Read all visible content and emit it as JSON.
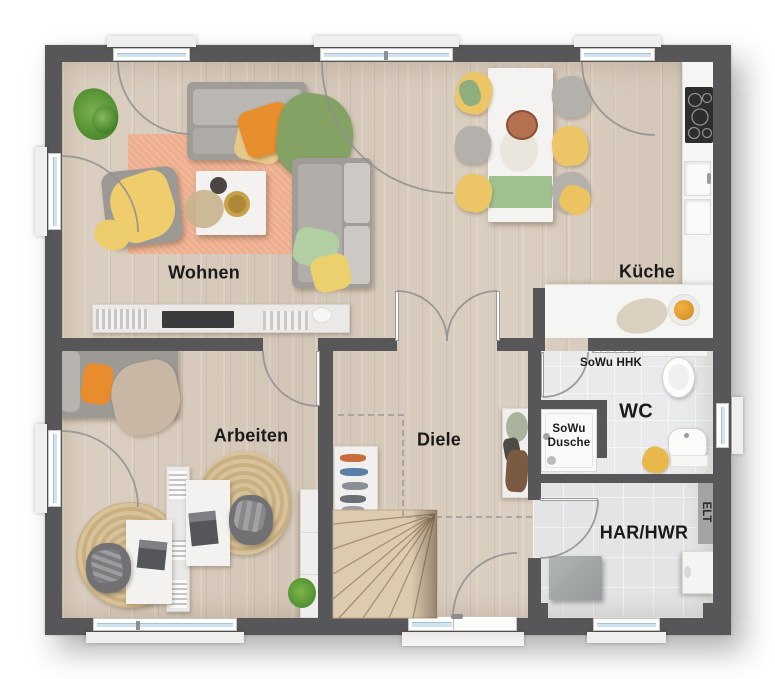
{
  "rooms": {
    "wohnen": {
      "label": "Wohnen"
    },
    "kueche": {
      "label": "Küche"
    },
    "arbeiten": {
      "label": "Arbeiten"
    },
    "diele": {
      "label": "Diele"
    },
    "wc": {
      "label": "WC"
    },
    "har_hwr": {
      "label": "HAR/HWR"
    }
  },
  "annotations": {
    "sowu_hhk": "SoWu HHK",
    "sowu_dusche": [
      "SoWu",
      "Dusche"
    ],
    "elt": "ELT"
  },
  "colors": {
    "wall": "#57575a",
    "wood_floor": "#d8ccbe",
    "tile_floor": "#e8eaec",
    "rug": "#eeae8e",
    "accent_orange": "#e88d2e",
    "accent_yellow": "#ecc566",
    "accent_green": "#83a264",
    "window_glass": "#cfe4f0",
    "label_text": "#1a1a1a"
  }
}
